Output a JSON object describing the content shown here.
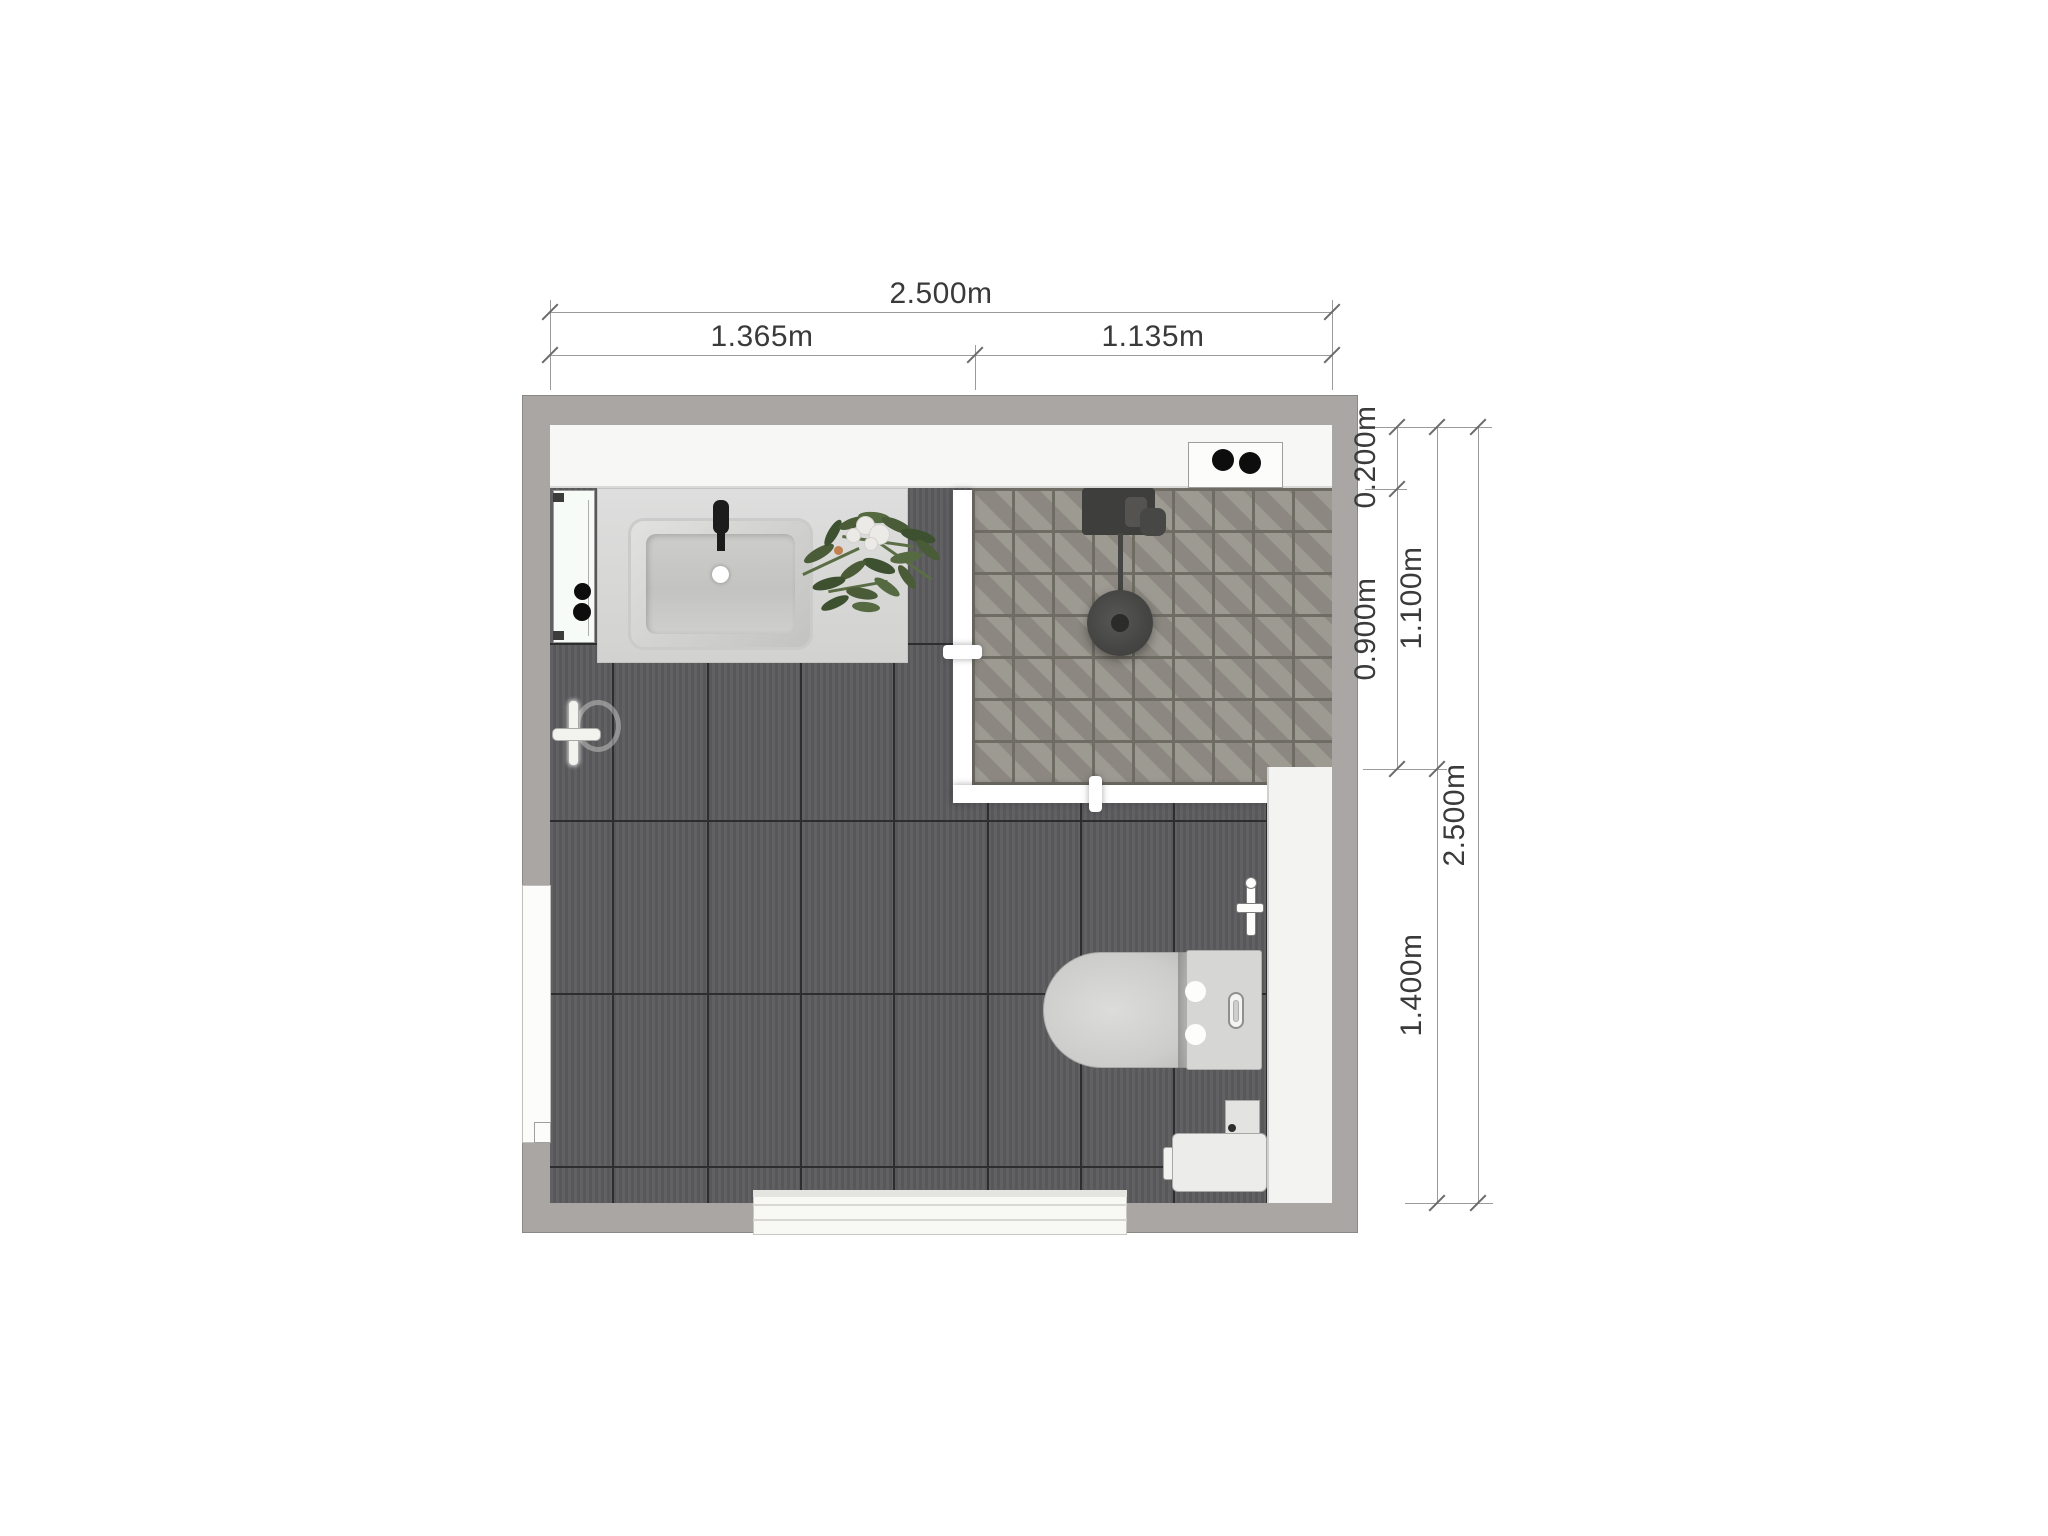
{
  "title": "bathroom-floor-plan",
  "dimensions": {
    "top_total": "2.500m",
    "top_left": "1.365m",
    "top_right": "1.135m",
    "right_inner_top": "0.200m",
    "right_inner_mid": "0.900m",
    "right_mid_top": "1.100m",
    "right_mid_bottom": "1.400m",
    "right_total": "2.500m"
  },
  "fixtures": [
    "mirror-cabinet",
    "vanity-counter",
    "sink",
    "faucet",
    "plant",
    "spotlight-niche",
    "shower-area",
    "shower-mixer",
    "rain-shower-head",
    "glass-partition",
    "towel-hook",
    "window-opening",
    "toilet",
    "water-valve",
    "side-ledge",
    "storage-unit",
    "door-threshold"
  ],
  "colors": {
    "wall": "#a9a6a4",
    "floor_tile": "#5b5b5e",
    "floor_grout": "#2d2d2f",
    "shower_tile": "#959189",
    "shower_grout": "#6f6c63",
    "counter": "#d8d8d6",
    "glass": "#ffffff",
    "fixture_white": "#f3f3f1",
    "dot_black": "#0d0d0d",
    "dim_line": "#9b9b9b",
    "dim_text": "#3a3a3a"
  }
}
